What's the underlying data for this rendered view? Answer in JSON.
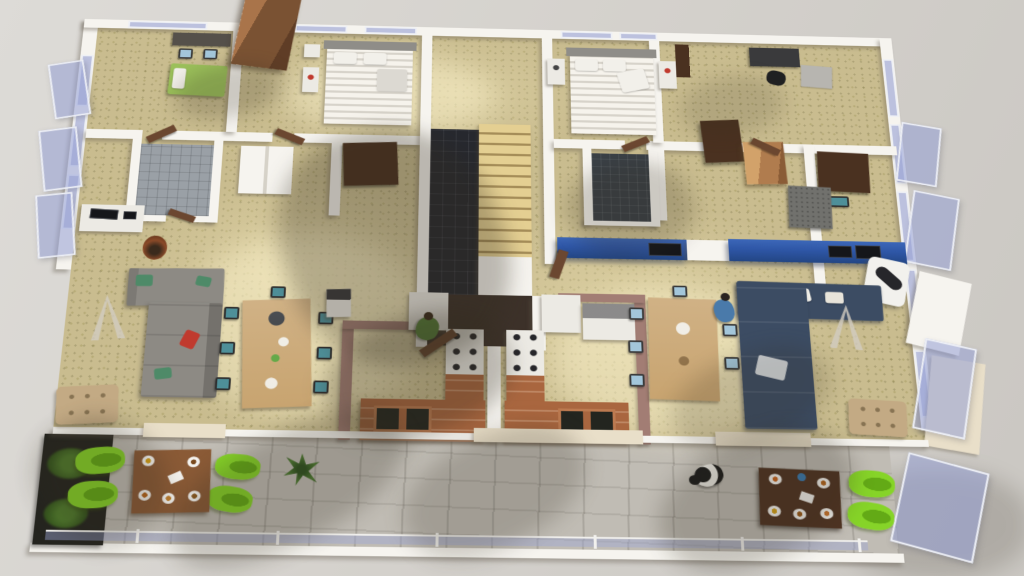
{
  "view": {
    "type": "3d-architectural-floorplan",
    "description": "Bird's-eye perspective cutaway render of a residential floor with two mirrored apartments, central staircase core, and a shared front balcony",
    "camera": "elevated front-top view",
    "visible_text": ""
  },
  "palette": {
    "bg": "#d5d2cd",
    "wall": "#f6f4ef",
    "floor": "#c9bc8f",
    "balcony": "#c0bcb4",
    "darkTile": "#26282e",
    "stair": "#d9c184",
    "stairEdge": "#a58d58",
    "vestibule": "#3c3129",
    "bathTile": "#9aa0a6",
    "terracotta": "#a9663f",
    "terracottaLight": "#bc7a50",
    "mauve": "#a27d74",
    "blueWall": "#2e56a6",
    "glassBorder": "#eef0f5",
    "sofaGray": "#8d8a84",
    "sofaNavy": "#3c4c63",
    "woodLight": "#c8a470",
    "woodMid": "#8a5a36",
    "woodDark": "#5d3a24",
    "woodDoor": "#6b4730",
    "wardrobe": "#7a5233",
    "wardrobeDark": "#4a3120",
    "tealChair": "#4e8f99",
    "blueChair": "#a3c6da",
    "greenChair": "#86d428",
    "greenChairDark": "#63aa16",
    "ottoman": "#c3aa84",
    "plantRust": "#8a4a28",
    "concrete": "#71716d",
    "cream": "#e9dfc9",
    "fridge": "#eceae4",
    "shadow": "rgba(50,44,30,0.30)",
    "sun": "rgba(255,246,208,0.45)",
    "personGreen": "#5a8a3c",
    "personBlue": "#4a7aaa",
    "red": "#c03a2e",
    "greenPillow": "#4e8a68"
  },
  "legend": {
    "units": [
      {
        "name": "left-apartment",
        "rooms": [
          "bedroom-1",
          "master-bedroom",
          "bathroom",
          "living-dining-room",
          "kitchen",
          "balcony"
        ],
        "furniture": [
          "desk-with-blue-chairs",
          "green-single-bed",
          "striped-double-bed",
          "tv-console",
          "gray-l-sofa",
          "tripod-floor-lamp",
          "tufted-ottoman",
          "wood-dining-table-teal-chairs",
          "u-shaped-terracotta-kitchen-counter",
          "gas-stove",
          "double-sink",
          "fridge",
          "balcony-dining-table",
          "green-lounge-chairs",
          "palm-plant",
          "standing-person"
        ]
      },
      {
        "name": "right-apartment",
        "rooms": [
          "master-bedroom",
          "office-bedroom",
          "bathroom",
          "living-dining-room",
          "kitchen",
          "balcony"
        ],
        "furniture": [
          "striped-double-bed",
          "office-desk-black-chair",
          "blue-tv-walls",
          "suspended-fireplace",
          "navy-l-sofa",
          "wood-dining-table-blue-chairs",
          "tripod-floor-lamp",
          "tufted-ottoman",
          "concrete-block",
          "wood-cabinet",
          "dark-wardrobe",
          "kitchen-counter",
          "balcony-dining-table",
          "green-lounge-chairs",
          "dog",
          "standing-person"
        ]
      }
    ],
    "shared": [
      "central-staircase",
      "dark-tile-landing",
      "entry-vestibule",
      "glass-facade-panels",
      "front-balcony",
      "planters"
    ]
  }
}
